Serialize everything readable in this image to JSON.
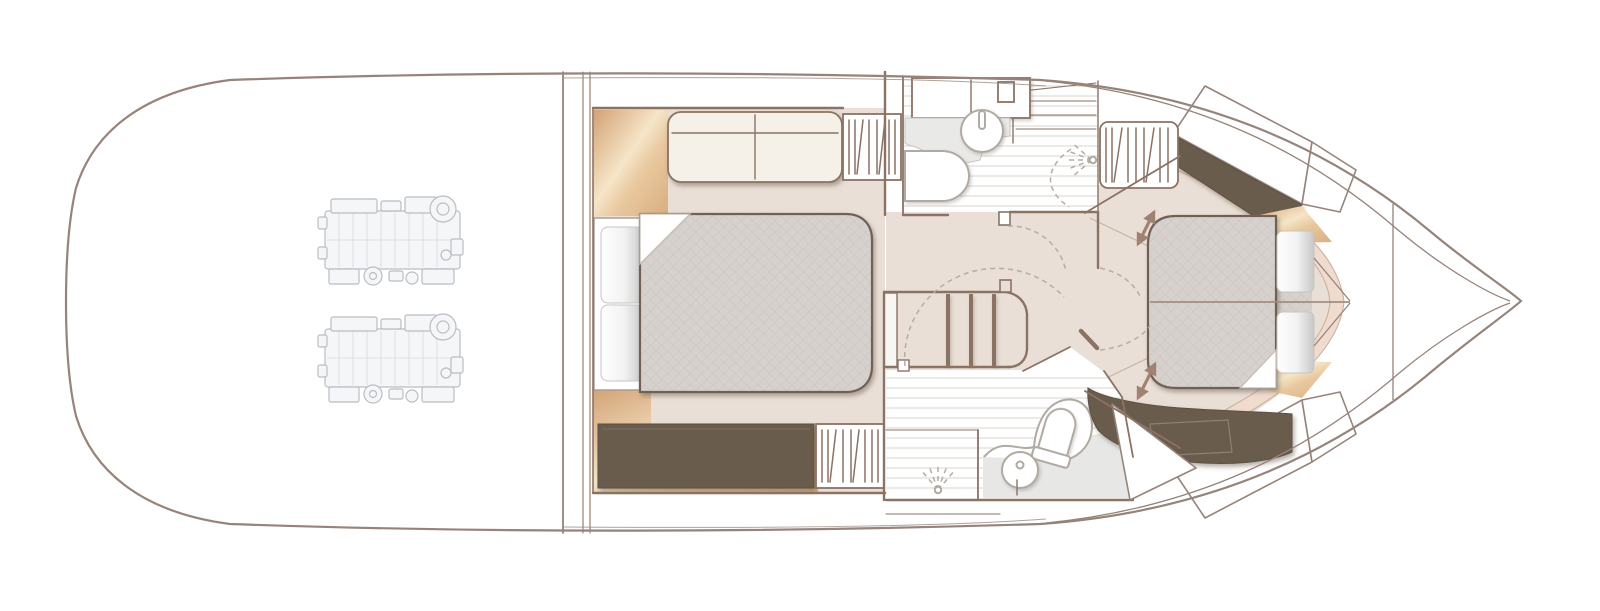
{
  "palette": {
    "hull-line": "#96837a",
    "wall-line": "#8a7265",
    "floor-beige": "#eadfd6",
    "floor-beige-dark": "#e0d2c5",
    "wood-light": "#f6e5c8",
    "wood-mid": "#e9c9a0",
    "wood-deep": "#d2a274",
    "dark-cabinet": "#6b5c4e",
    "bed-gray": "#d7d1ce",
    "bed-hatch": "#cac3bf",
    "bed-border": "#6f6156",
    "sofa-cream": "#f6f1e8",
    "plank-line": "#d9d4ce",
    "tile-gray": "#e7e7e5",
    "fixture-line": "#b0aaa2",
    "dashed-line": "#b8aca1",
    "pink-band": "#f0dcce",
    "pink-band-edge": "#c9b09e",
    "arrow-brown": "#a08273",
    "seam-line": "#a18e81",
    "step-line": "#c9b6a4",
    "engine-line": "#b9bdc2",
    "engine-fill": "#f5f6f8",
    "shadow": "#6a5c50"
  },
  "rooms": [
    {
      "name": "engine-room",
      "features": [
        "port-engine",
        "starboard-engine"
      ]
    },
    {
      "name": "mid-cabin",
      "features": [
        "double-bed",
        "pillows",
        "sofa",
        "wardrobe-aft",
        "wardrobe-forward",
        "dresser"
      ]
    },
    {
      "name": "day-head",
      "features": [
        "cabinet",
        "washbasin",
        "toilet",
        "shower",
        "door-swing"
      ]
    },
    {
      "name": "staircase",
      "features": [
        "treads",
        "newel-post",
        "handrail"
      ]
    },
    {
      "name": "landing",
      "features": [
        "door-swings"
      ]
    },
    {
      "name": "ensuite-bathroom",
      "features": [
        "shower",
        "washbasin",
        "toilet",
        "door-swing"
      ]
    },
    {
      "name": "forward-cabin",
      "features": [
        "double-bed",
        "pillows",
        "wardrobe",
        "side-shelves",
        "adjustable-berth-arrows"
      ]
    },
    {
      "name": "bow",
      "features": [
        "foredeck-chord",
        "hull-taper"
      ]
    }
  ],
  "icons": [
    "engine-icon",
    "hanger-icon",
    "basin-icon",
    "toilet-icon",
    "shower-spray-icon",
    "door-swing-icon",
    "double-arrow-icon",
    "bed-icon",
    "sofa-icon",
    "pillow-icon",
    "stairs-icon"
  ]
}
